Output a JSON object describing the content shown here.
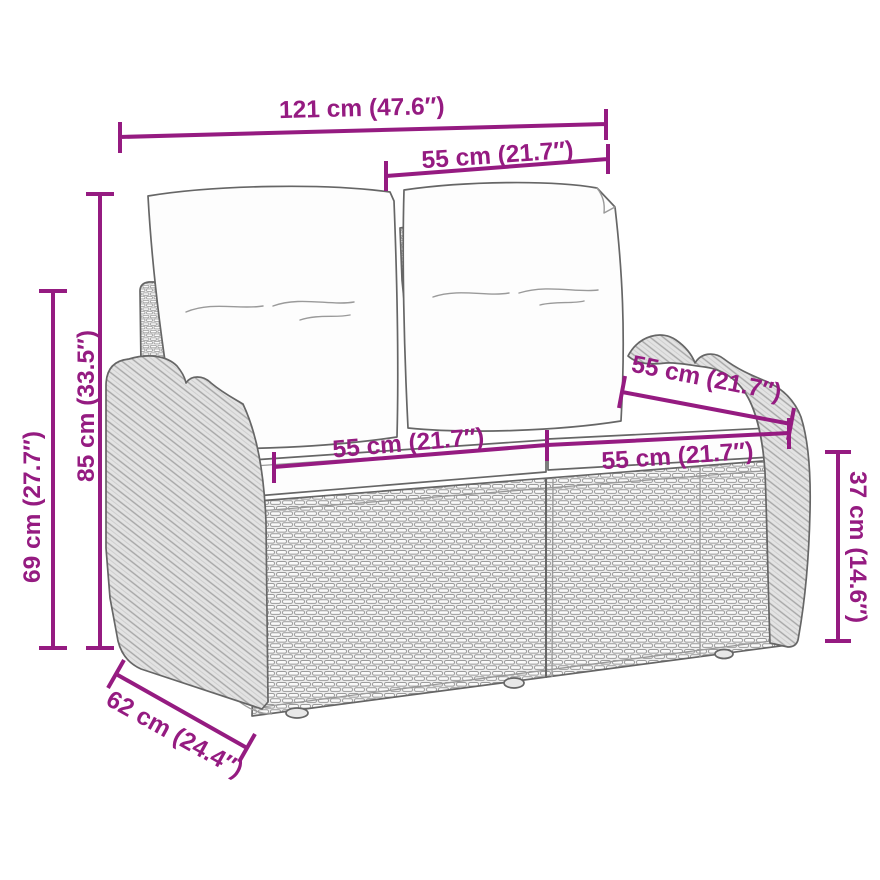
{
  "page": {
    "title": "Garden bench dimension diagram",
    "background_color": "#ffffff"
  },
  "diagram": {
    "type": "product-dimension-diagram",
    "subject": "poly rattan garden bench with cushions, line-art drawing",
    "accent_color": "#951b81",
    "line_art_color": "#666666",
    "wicker_fill_color": "#ececec",
    "cushion_fill_color": "#fdfdfd",
    "dimensions": [
      {
        "id": "overall-width",
        "label": "121 cm (47.6″)"
      },
      {
        "id": "back-cushion-width-top",
        "label": "55 cm (21.7″)"
      },
      {
        "id": "total-height",
        "label": "85 cm (33.5″)"
      },
      {
        "id": "armrest-height",
        "label": "69 cm (27.7″)"
      },
      {
        "id": "seat-width-left",
        "label": "55 cm (21.7″)"
      },
      {
        "id": "seat-width-right",
        "label": "55 cm (21.7″)"
      },
      {
        "id": "back-cushion-width-diagonal",
        "label": "55 cm (21.7″)"
      },
      {
        "id": "seat-height",
        "label": "37 cm (14.6″)"
      },
      {
        "id": "seat-depth",
        "label": "62 cm (24.4″)"
      }
    ]
  }
}
